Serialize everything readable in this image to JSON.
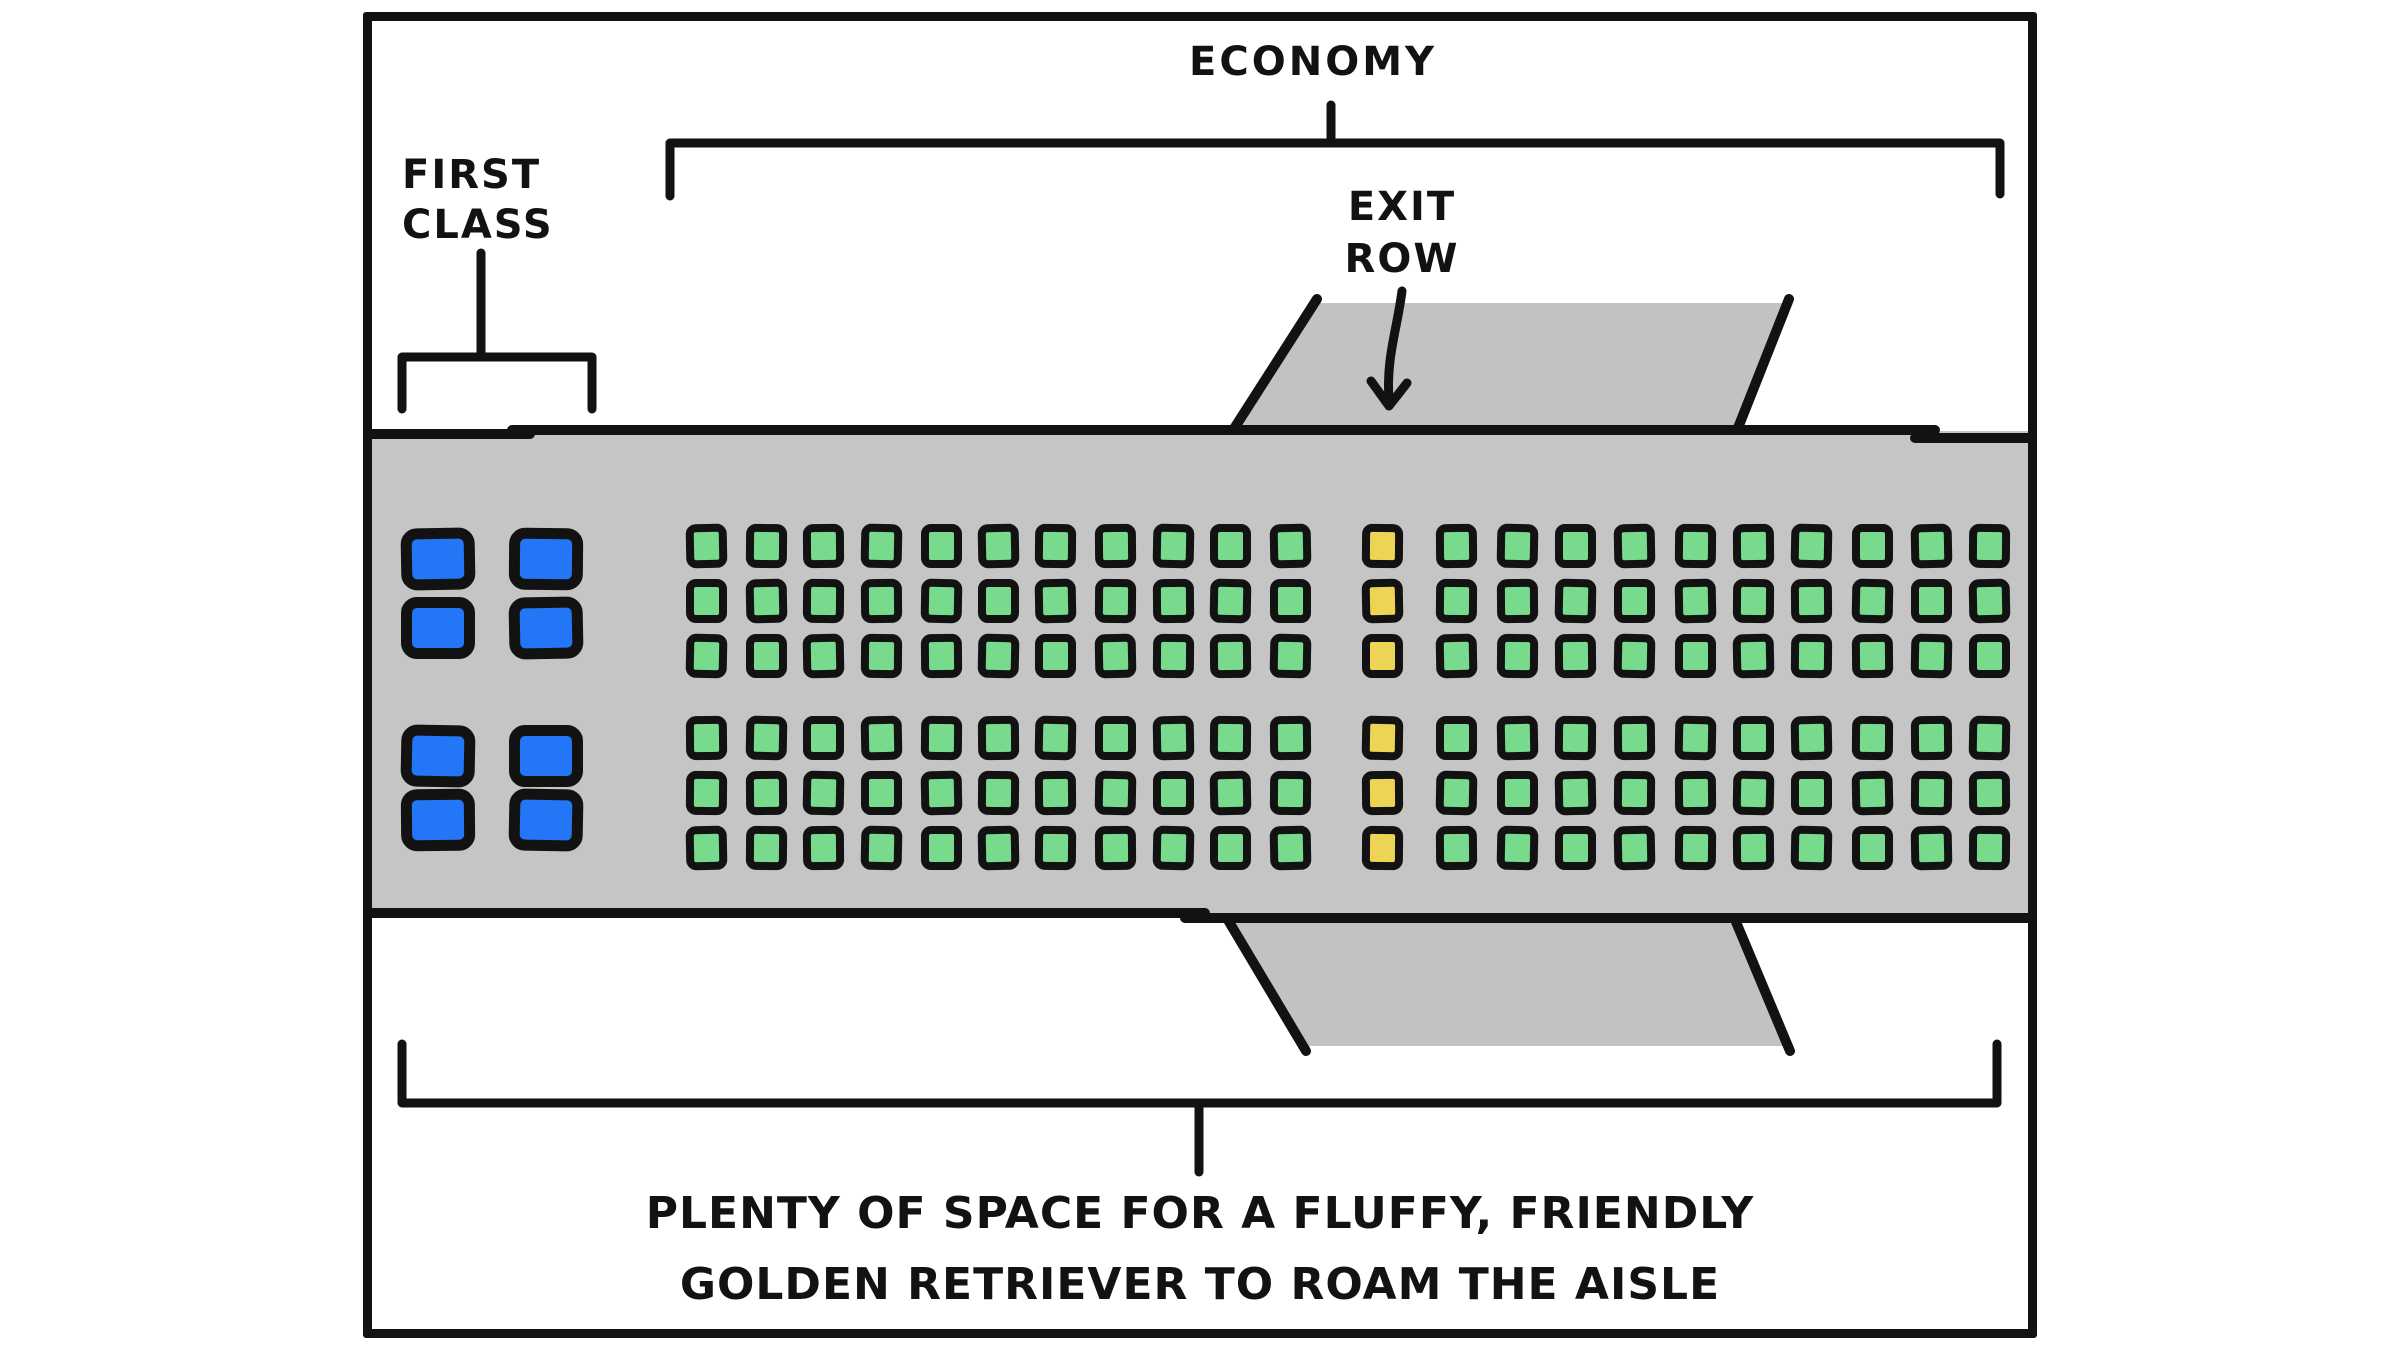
{
  "labels": {
    "economy": "ECONOMY",
    "first_class_line1": "FIRST",
    "first_class_line2": "CLASS",
    "exit_row_line1": "EXIT",
    "exit_row_line2": "ROW",
    "caption_line1": "PLENTY OF SPACE FOR A FLUFFY, FRIENDLY",
    "caption_line2": "GOLDEN RETRIEVER TO ROAM THE AISLE"
  },
  "seat_map": {
    "first_class": {
      "groups": 2,
      "rows_per_group": 2,
      "cols_per_group": 2,
      "total_seats": 8,
      "seat_color": "#2376f6"
    },
    "economy": {
      "sections": 2,
      "rows_per_section": 3,
      "left_block_cols": 11,
      "exit_row_cols": 1,
      "right_block_cols": 10,
      "total_standard_seats": 126,
      "total_exit_row_seats": 6,
      "seat_color": "#77da8c",
      "exit_seat_color": "#eed454"
    }
  },
  "colors": {
    "ink": "#121212",
    "background": "#ffffff",
    "fuselage": "#c5c5c5",
    "wing": "#c2c2c2"
  }
}
